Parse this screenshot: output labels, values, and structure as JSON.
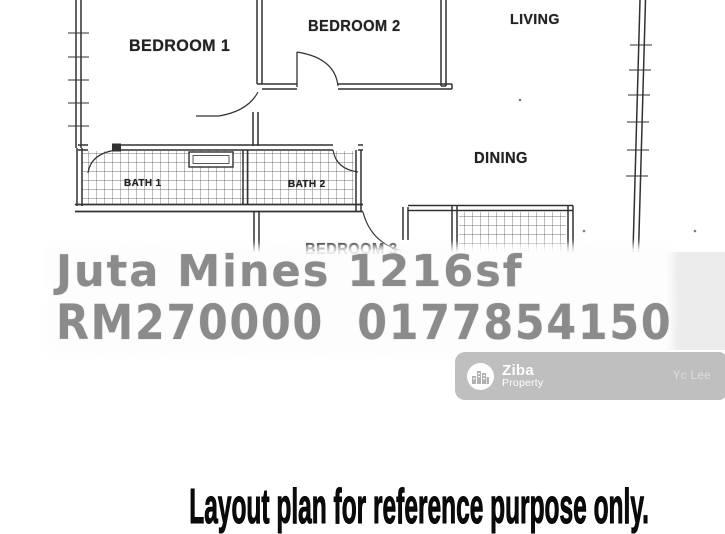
{
  "floor_plan": {
    "rooms": [
      {
        "label": "BEDROOM 1"
      },
      {
        "label": "BEDROOM 2"
      },
      {
        "label": "LIVING"
      },
      {
        "label": "DINING"
      },
      {
        "label": "BATH 1"
      },
      {
        "label": "BATH 2"
      },
      {
        "label": "BEDROOM 3"
      }
    ]
  },
  "watermark": {
    "line1": "Juta Mines 1216sf",
    "line2": "RM270000  0177854150",
    "text_color": "#8b8b8b"
  },
  "badge": {
    "brand": "Ziba",
    "brand_sub": "Property",
    "agent": "Yc Lee",
    "bg_color": "#bfbfbf",
    "logo_icon": "buildings-icon"
  },
  "footer": {
    "note": "Layout plan for reference purpose only."
  }
}
